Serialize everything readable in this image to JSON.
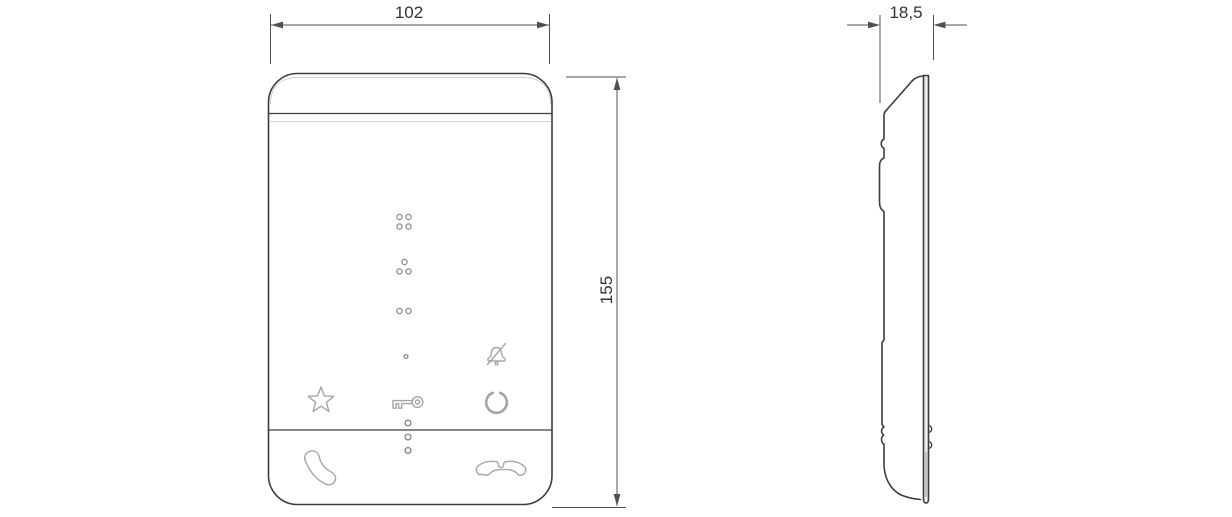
{
  "drawing": {
    "dimensions": {
      "width": "102",
      "height": "155",
      "depth": "18,5"
    },
    "icons": [
      "braille-dots-group-1",
      "braille-dots-group-2",
      "braille-dots-group-3",
      "braille-dot-single",
      "bell-mute-icon",
      "star-icon",
      "key-icon",
      "ring-icon",
      "led-indicator-dots",
      "phone-handset-icon",
      "phone-hangup-icon"
    ],
    "colors": {
      "background": "#ffffff",
      "outline": "#3d3d3d",
      "secondary": "#9a9a9a",
      "icon": "#a5a5a5",
      "braille": "#8a8a8a",
      "dimension": "#4f4f4f",
      "text": "#333333",
      "backplate": "#ececec"
    }
  }
}
